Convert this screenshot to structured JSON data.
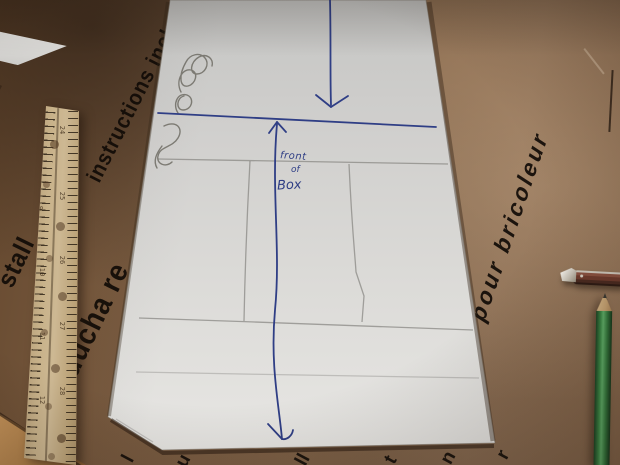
{
  "cardboard": {
    "prints": [
      {
        "text": "instructions inclu"
      },
      {
        "text": "stall"
      },
      {
        "text": "a ducha re"
      },
      {
        "text": "llations pour bricoleur"
      }
    ],
    "fragments": [
      "l",
      "u",
      "ll",
      "t",
      "n",
      "r"
    ]
  },
  "board": {
    "handwriting": {
      "line1": "front",
      "line2": "of",
      "line3": "Box"
    }
  },
  "ruler": {
    "left_numbers": [
      "8",
      "9",
      "10",
      "11",
      "12"
    ],
    "right_numbers": [
      "24",
      "25",
      "26",
      "27",
      "28"
    ]
  },
  "colors": {
    "cardboard": "#8a6b4f",
    "cardboard_dark": "#5d4733",
    "cardboard_light": "#97785a",
    "board_white": "#d9d8d5",
    "ink": "#2f3e85",
    "pencil_line": "#8a8884",
    "print_black": "#14100b",
    "ruler_wood": "#c3ab85",
    "pencil_green": "#3c7d45",
    "knife_handle": "#6e3f30",
    "floor_tan": "#b5854f"
  }
}
